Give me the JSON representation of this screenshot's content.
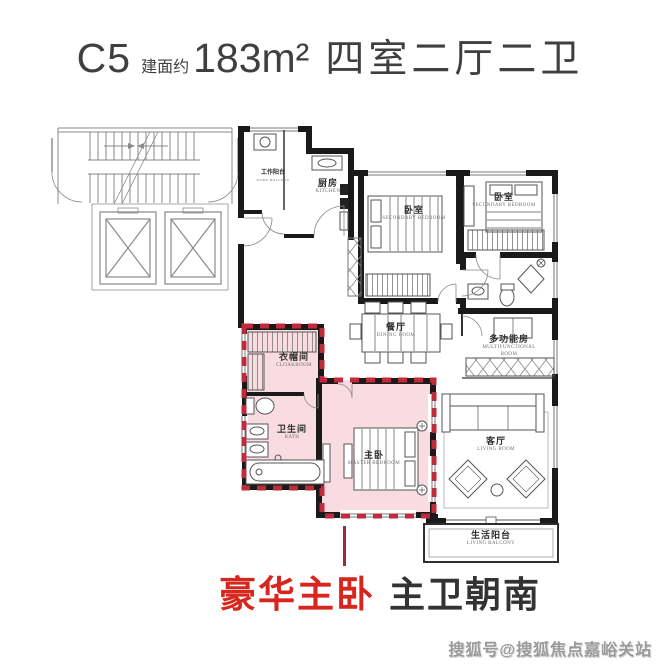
{
  "title": {
    "model": "C5",
    "area_prefix": "建面约",
    "area": "183m²",
    "layout": "四室二厅二卫"
  },
  "rooms": {
    "work_balcony": {
      "zh": "工作阳台",
      "en": "WORK BALCONY"
    },
    "kitchen": {
      "zh": "厨房",
      "en": "KITCHEN"
    },
    "bedroom_mid": {
      "zh": "卧室",
      "en": "SECONDARY BEDROOM"
    },
    "bedroom_right": {
      "zh": "卧室",
      "en": "SECONDARY BEDROOM"
    },
    "dining": {
      "zh": "餐厅",
      "en": "DINING ROOM"
    },
    "multi": {
      "zh": "多功能房",
      "en": "MULTIFUNCTIONAL ROOM"
    },
    "cloakroom": {
      "zh": "衣帽间",
      "en": "CLOAKROOM"
    },
    "bath": {
      "zh": "卫生间",
      "en": "BATH"
    },
    "master": {
      "zh": "主卧",
      "en": "MASTER BEDROOM"
    },
    "living": {
      "zh": "客厅",
      "en": "LIVING ROOM"
    },
    "living_balcony": {
      "zh": "生活阳台",
      "en": "LIVING BALCONY"
    }
  },
  "caption": {
    "highlight": "豪华主卧",
    "detail": "主卫朝南"
  },
  "watermark": {
    "text": "搜狐号@搜狐焦点嘉峪关站"
  },
  "colors": {
    "highlight_fill": "#f8dce1",
    "highlight_dash": "#bf2b3d",
    "caption_red": "#d7261d",
    "leader_line": "#a3293a",
    "wall_black": "#1a1a1a"
  }
}
